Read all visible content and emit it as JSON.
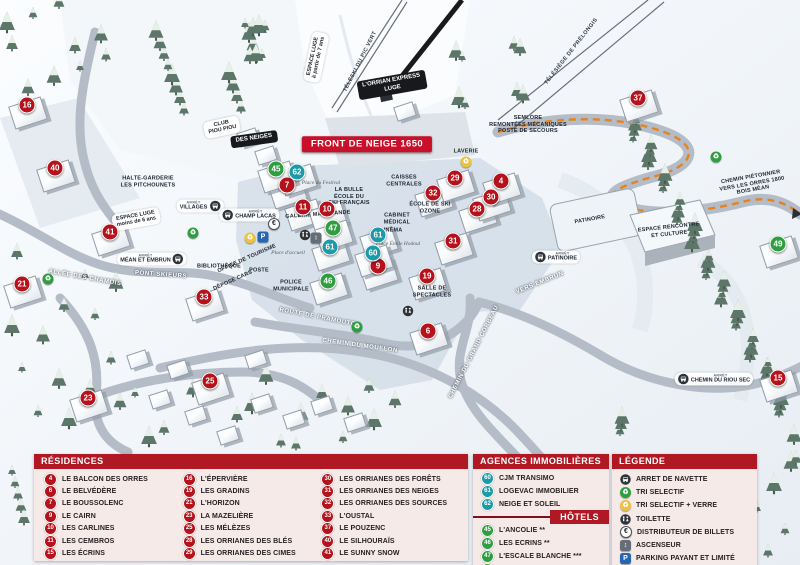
{
  "colors": {
    "header_red": "#b01823",
    "marker_red": "#b5121b",
    "marker_teal": "#1d9aa8",
    "marker_green": "#2f9e41",
    "panel_pink": "#f6e9e7",
    "parking_blue": "#2767b1",
    "path_orange": "#e8821e"
  },
  "map": {
    "stop_prefix": "ARRÊT",
    "markers": [
      {
        "n": "16",
        "c": "red",
        "x": 27,
        "y": 105
      },
      {
        "n": "40",
        "c": "red",
        "x": 55,
        "y": 168
      },
      {
        "n": "41",
        "c": "red",
        "x": 110,
        "y": 232
      },
      {
        "n": "21",
        "c": "red",
        "x": 22,
        "y": 284
      },
      {
        "n": "33",
        "c": "red",
        "x": 204,
        "y": 297
      },
      {
        "n": "23",
        "c": "red",
        "x": 88,
        "y": 398
      },
      {
        "n": "25",
        "c": "red",
        "x": 210,
        "y": 381
      },
      {
        "n": "7",
        "c": "red",
        "x": 287,
        "y": 185
      },
      {
        "n": "11",
        "c": "red",
        "x": 303,
        "y": 207
      },
      {
        "n": "10",
        "c": "red",
        "x": 327,
        "y": 209
      },
      {
        "n": "9",
        "c": "red",
        "x": 378,
        "y": 266
      },
      {
        "n": "19",
        "c": "red",
        "x": 427,
        "y": 276
      },
      {
        "n": "6",
        "c": "red",
        "x": 428,
        "y": 331
      },
      {
        "n": "31",
        "c": "red",
        "x": 453,
        "y": 241
      },
      {
        "n": "28",
        "c": "red",
        "x": 477,
        "y": 209
      },
      {
        "n": "30",
        "c": "red",
        "x": 491,
        "y": 197
      },
      {
        "n": "4",
        "c": "red",
        "x": 501,
        "y": 181
      },
      {
        "n": "32",
        "c": "red",
        "x": 433,
        "y": 193
      },
      {
        "n": "29",
        "c": "red",
        "x": 455,
        "y": 178
      },
      {
        "n": "37",
        "c": "red",
        "x": 638,
        "y": 98
      },
      {
        "n": "15",
        "c": "red",
        "x": 778,
        "y": 378
      },
      {
        "n": "62",
        "c": "teal",
        "x": 297,
        "y": 172
      },
      {
        "n": "61",
        "c": "teal",
        "x": 330,
        "y": 247
      },
      {
        "n": "61",
        "c": "teal",
        "x": 378,
        "y": 235
      },
      {
        "n": "60",
        "c": "teal",
        "x": 373,
        "y": 253
      },
      {
        "n": "45",
        "c": "green",
        "x": 276,
        "y": 169
      },
      {
        "n": "47",
        "c": "green",
        "x": 333,
        "y": 228
      },
      {
        "n": "46",
        "c": "green",
        "x": 328,
        "y": 281
      },
      {
        "n": "49",
        "c": "green",
        "x": 778,
        "y": 244
      }
    ],
    "labels": [
      {
        "t": "FRONT DE NEIGE 1650",
        "x": 367,
        "y": 144,
        "r": 0,
        "k": "banner"
      },
      {
        "t": "L'ORRIAN EXPRESS\nLUGE",
        "x": 392,
        "y": 85,
        "r": -10,
        "k": "pilldark"
      },
      {
        "t": "TÉLÉSKI DU PIC VERT",
        "x": 361,
        "y": 62,
        "r": -63,
        "k": "lift"
      },
      {
        "t": "TÉLÉSIÈGE DE PRÉLONGIS",
        "x": 572,
        "y": 52,
        "r": -52,
        "k": "lift"
      },
      {
        "t": "ESPACE LUGE\nà partir de 7 ans",
        "x": 316,
        "y": 57,
        "r": -78,
        "k": "pill"
      },
      {
        "t": "ESPACE LUGE\nmoins de 6 ans",
        "x": 136,
        "y": 219,
        "r": -10,
        "k": "pill"
      },
      {
        "t": "CLUB\nPIOU PIOU",
        "x": 222,
        "y": 127,
        "r": -12,
        "k": "pill"
      },
      {
        "t": "DES NEIGES",
        "x": 254,
        "y": 139,
        "r": -8,
        "k": "pilldark"
      },
      {
        "t": "HALTE-GARDERIE\nLES PITCHOUNETS",
        "x": 148,
        "y": 182,
        "r": 0,
        "k": "poi"
      },
      {
        "t": "SEMLORE\nREMONTÉES MÉCANIQUES\nPOSTE DE SECOURS",
        "x": 528,
        "y": 125,
        "r": 0,
        "k": "poi"
      },
      {
        "t": "CHEMIN PIÉTONNIER\nVERS LES ORRES 1800\nBOIS MÉAN",
        "x": 752,
        "y": 184,
        "r": -10,
        "k": "poi"
      },
      {
        "t": "Place du Festival",
        "x": 321,
        "y": 183,
        "r": 0,
        "k": "place"
      },
      {
        "t": "LA BULLE\nÉCOLE DU\nSKI FRANÇAIS",
        "x": 349,
        "y": 197,
        "r": 0,
        "k": "poi"
      },
      {
        "t": "CAISSES\nCENTRALES",
        "x": 404,
        "y": 181,
        "r": 0,
        "k": "poi"
      },
      {
        "t": "GALERIE MARCHANDE",
        "x": 318,
        "y": 215,
        "r": -4,
        "k": "poi"
      },
      {
        "t": "CABINET\nMÉDICAL",
        "x": 397,
        "y": 219,
        "r": 0,
        "k": "poi"
      },
      {
        "t": "CINÉMA",
        "x": 391,
        "y": 231,
        "r": 0,
        "k": "poi"
      },
      {
        "t": "ÉCOLE DE SKI\nOZONE",
        "x": 430,
        "y": 208,
        "r": 0,
        "k": "poi"
      },
      {
        "t": "LAVERIE",
        "x": 466,
        "y": 152,
        "r": 0,
        "k": "poi"
      },
      {
        "t": "PATINOIRE",
        "x": 590,
        "y": 220,
        "r": -10,
        "k": "poi"
      },
      {
        "t": "ESPACE RENCONTRE\nET CULTURE",
        "x": 669,
        "y": 231,
        "r": -6,
        "k": "poi"
      },
      {
        "t": "OFFICE DE TOURISME",
        "x": 247,
        "y": 259,
        "r": -24,
        "k": "poi"
      },
      {
        "t": "BIBLIOTHÈQUE",
        "x": 219,
        "y": 267,
        "r": 0,
        "k": "poi"
      },
      {
        "t": "DÉPOSE CARS",
        "x": 233,
        "y": 281,
        "r": -24,
        "k": "poi"
      },
      {
        "t": "POSTE",
        "x": 259,
        "y": 271,
        "r": 0,
        "k": "poi"
      },
      {
        "t": "POLICE\nMUNICIPALE",
        "x": 291,
        "y": 286,
        "r": 0,
        "k": "poi"
      },
      {
        "t": "Place d'accueil",
        "x": 288,
        "y": 253,
        "r": 0,
        "k": "place"
      },
      {
        "t": "Place Émile Hodoul",
        "x": 398,
        "y": 244,
        "r": 0,
        "k": "place"
      },
      {
        "t": "SALLE DE\nSPECTACLES",
        "x": 432,
        "y": 292,
        "r": 0,
        "k": "poi"
      },
      {
        "t": "ALLÉE DES CHAMOIS",
        "x": 85,
        "y": 278,
        "r": 10,
        "k": "road"
      },
      {
        "t": "PONT SKIEURS",
        "x": 161,
        "y": 275,
        "r": 4,
        "k": "road"
      },
      {
        "t": "ROUTE DE PRAMOUTON",
        "x": 320,
        "y": 318,
        "r": 11,
        "k": "road"
      },
      {
        "t": "CHEMIN DU MOUFLON",
        "x": 360,
        "y": 346,
        "r": 8,
        "k": "road"
      },
      {
        "t": "CHEMIN DU GRAND CORBEAU",
        "x": 474,
        "y": 352,
        "r": -63,
        "k": "road"
      },
      {
        "t": "VERS EMBRUN",
        "x": 540,
        "y": 283,
        "r": -22,
        "k": "road"
      }
    ],
    "stops": [
      {
        "t": "VILLAGES",
        "x": 200,
        "y": 206,
        "side": "r"
      },
      {
        "t": "CHAMP LACAS",
        "x": 249,
        "y": 215,
        "side": "l"
      },
      {
        "t": "MÉAN ET EMBRUN",
        "x": 152,
        "y": 259,
        "side": "r"
      },
      {
        "t": "PATINOIRE",
        "x": 556,
        "y": 257,
        "side": "l"
      },
      {
        "t": "CHEMIN DU RIOU SEC",
        "x": 714,
        "y": 379,
        "side": "l"
      }
    ],
    "icons": [
      {
        "t": "recycle",
        "x": 193,
        "y": 233
      },
      {
        "t": "recycle",
        "x": 48,
        "y": 279
      },
      {
        "t": "recycle",
        "x": 357,
        "y": 327
      },
      {
        "t": "recycle",
        "x": 716,
        "y": 157
      },
      {
        "t": "waste",
        "x": 250,
        "y": 238
      },
      {
        "t": "waste",
        "x": 466,
        "y": 162
      },
      {
        "t": "toilet",
        "x": 305,
        "y": 235
      },
      {
        "t": "toilet",
        "x": 408,
        "y": 311
      },
      {
        "t": "euro",
        "x": 274,
        "y": 224
      },
      {
        "t": "parking",
        "x": 263,
        "y": 237
      },
      {
        "t": "elevator",
        "x": 316,
        "y": 238
      }
    ]
  },
  "panels": {
    "residences": {
      "title": "RÉSIDENCES",
      "items": [
        {
          "n": "4",
          "label": "LE BALCON DES ORRES"
        },
        {
          "n": "6",
          "label": "LE BELVÉDÈRE"
        },
        {
          "n": "7",
          "label": "LE BOUSSOLENC"
        },
        {
          "n": "9",
          "label": "LE CAIRN"
        },
        {
          "n": "10",
          "label": "LES CARLINES"
        },
        {
          "n": "11",
          "label": "LES CEMBROS"
        },
        {
          "n": "15",
          "label": "LES ÉCRINS"
        },
        {
          "n": "16",
          "label": "L'ÉPERVIÈRE"
        },
        {
          "n": "19",
          "label": "LES GRADINS"
        },
        {
          "n": "21",
          "label": "L'HORIZON"
        },
        {
          "n": "23",
          "label": "LA MAZELIÈRE"
        },
        {
          "n": "25",
          "label": "LES MÉLÈZES"
        },
        {
          "n": "28",
          "label": "LES ORRIANES DES BLÉS"
        },
        {
          "n": "29",
          "label": "LES ORRIANES DES CIMES"
        },
        {
          "n": "30",
          "label": "LES ORRIANES DES FORÊTS"
        },
        {
          "n": "31",
          "label": "LES ORRIANES DES NEIGES"
        },
        {
          "n": "32",
          "label": "LES ORRIANES DES SOURCES"
        },
        {
          "n": "33",
          "label": "L'OUSTAL"
        },
        {
          "n": "37",
          "label": "LE POUZENC"
        },
        {
          "n": "40",
          "label": "LE SILHOURAÏS"
        },
        {
          "n": "41",
          "label": "LE SUNNY SNOW"
        }
      ]
    },
    "agences": {
      "title": "AGENCES IMMOBILIÈRES",
      "items": [
        {
          "n": "60",
          "label": "CJM TRANSIMO"
        },
        {
          "n": "61",
          "label": "LOGEVAC IMMOBILIER"
        },
        {
          "n": "62",
          "label": "NEIGE ET SOLEIL"
        }
      ]
    },
    "hotels": {
      "title": "HÔTELS",
      "items": [
        {
          "n": "45",
          "label": "L'ANCOLIE **"
        },
        {
          "n": "46",
          "label": "LES ECRINS **"
        },
        {
          "n": "47",
          "label": "L'ESCALE BLANCHE ***"
        },
        {
          "n": "49",
          "label": "LES TRAPPEURS **"
        }
      ]
    },
    "legende": {
      "title": "LÉGENDE",
      "items": [
        {
          "icon": "bus",
          "label": "ARRET DE NAVETTE"
        },
        {
          "icon": "recycle",
          "label": "TRI SELECTIF"
        },
        {
          "icon": "waste",
          "label": "TRI SELECTIF + VERRE"
        },
        {
          "icon": "toilet",
          "label": "TOILETTE"
        },
        {
          "icon": "euro",
          "label": "DISTRIBUTEUR DE BILLETS"
        },
        {
          "icon": "elevator",
          "label": "ASCENSEUR"
        },
        {
          "icon": "parking",
          "label": "PARKING PAYANT ET LIMITÉ"
        }
      ]
    }
  }
}
